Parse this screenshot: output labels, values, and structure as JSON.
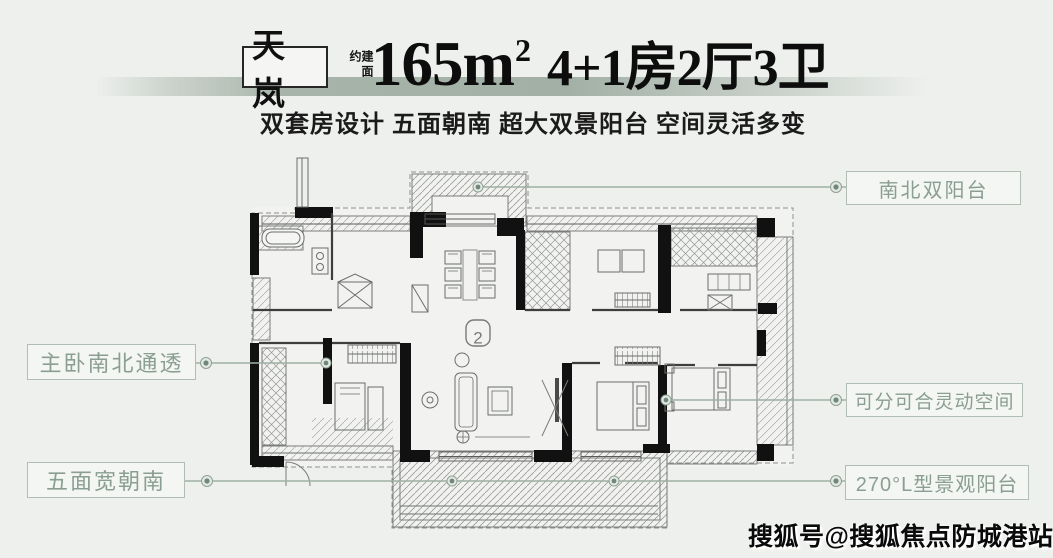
{
  "header": {
    "badge": "天岚",
    "area_prefix": "建面约",
    "area_value": "165m",
    "area_sup": "2",
    "spec": "4+1房2厅3卫",
    "subtitle": "双套房设计 五面朝南 超大双景阳台 空间灵活多变"
  },
  "callouts": {
    "top_right": "南北双阳台",
    "left": "主卧南北通透",
    "right_mid": "可分可合灵动空间",
    "bottom_left": "五面宽朝南",
    "bottom_right": "270°L型景观阳台"
  },
  "plan": {
    "unit_badge": "2"
  },
  "watermark": "搜狐号@搜狐焦点防城港站",
  "colors": {
    "background": "#eef0ed",
    "title_ink": "#0d0d0d",
    "band_green": "#a7b4aa",
    "callout_text": "#8a9e92",
    "callout_border": "#b2beb4",
    "callout_line": "#9db0a3",
    "dot_fill": "#70887b",
    "wall_black": "#111111",
    "plan_line": "#5a5a5a"
  }
}
